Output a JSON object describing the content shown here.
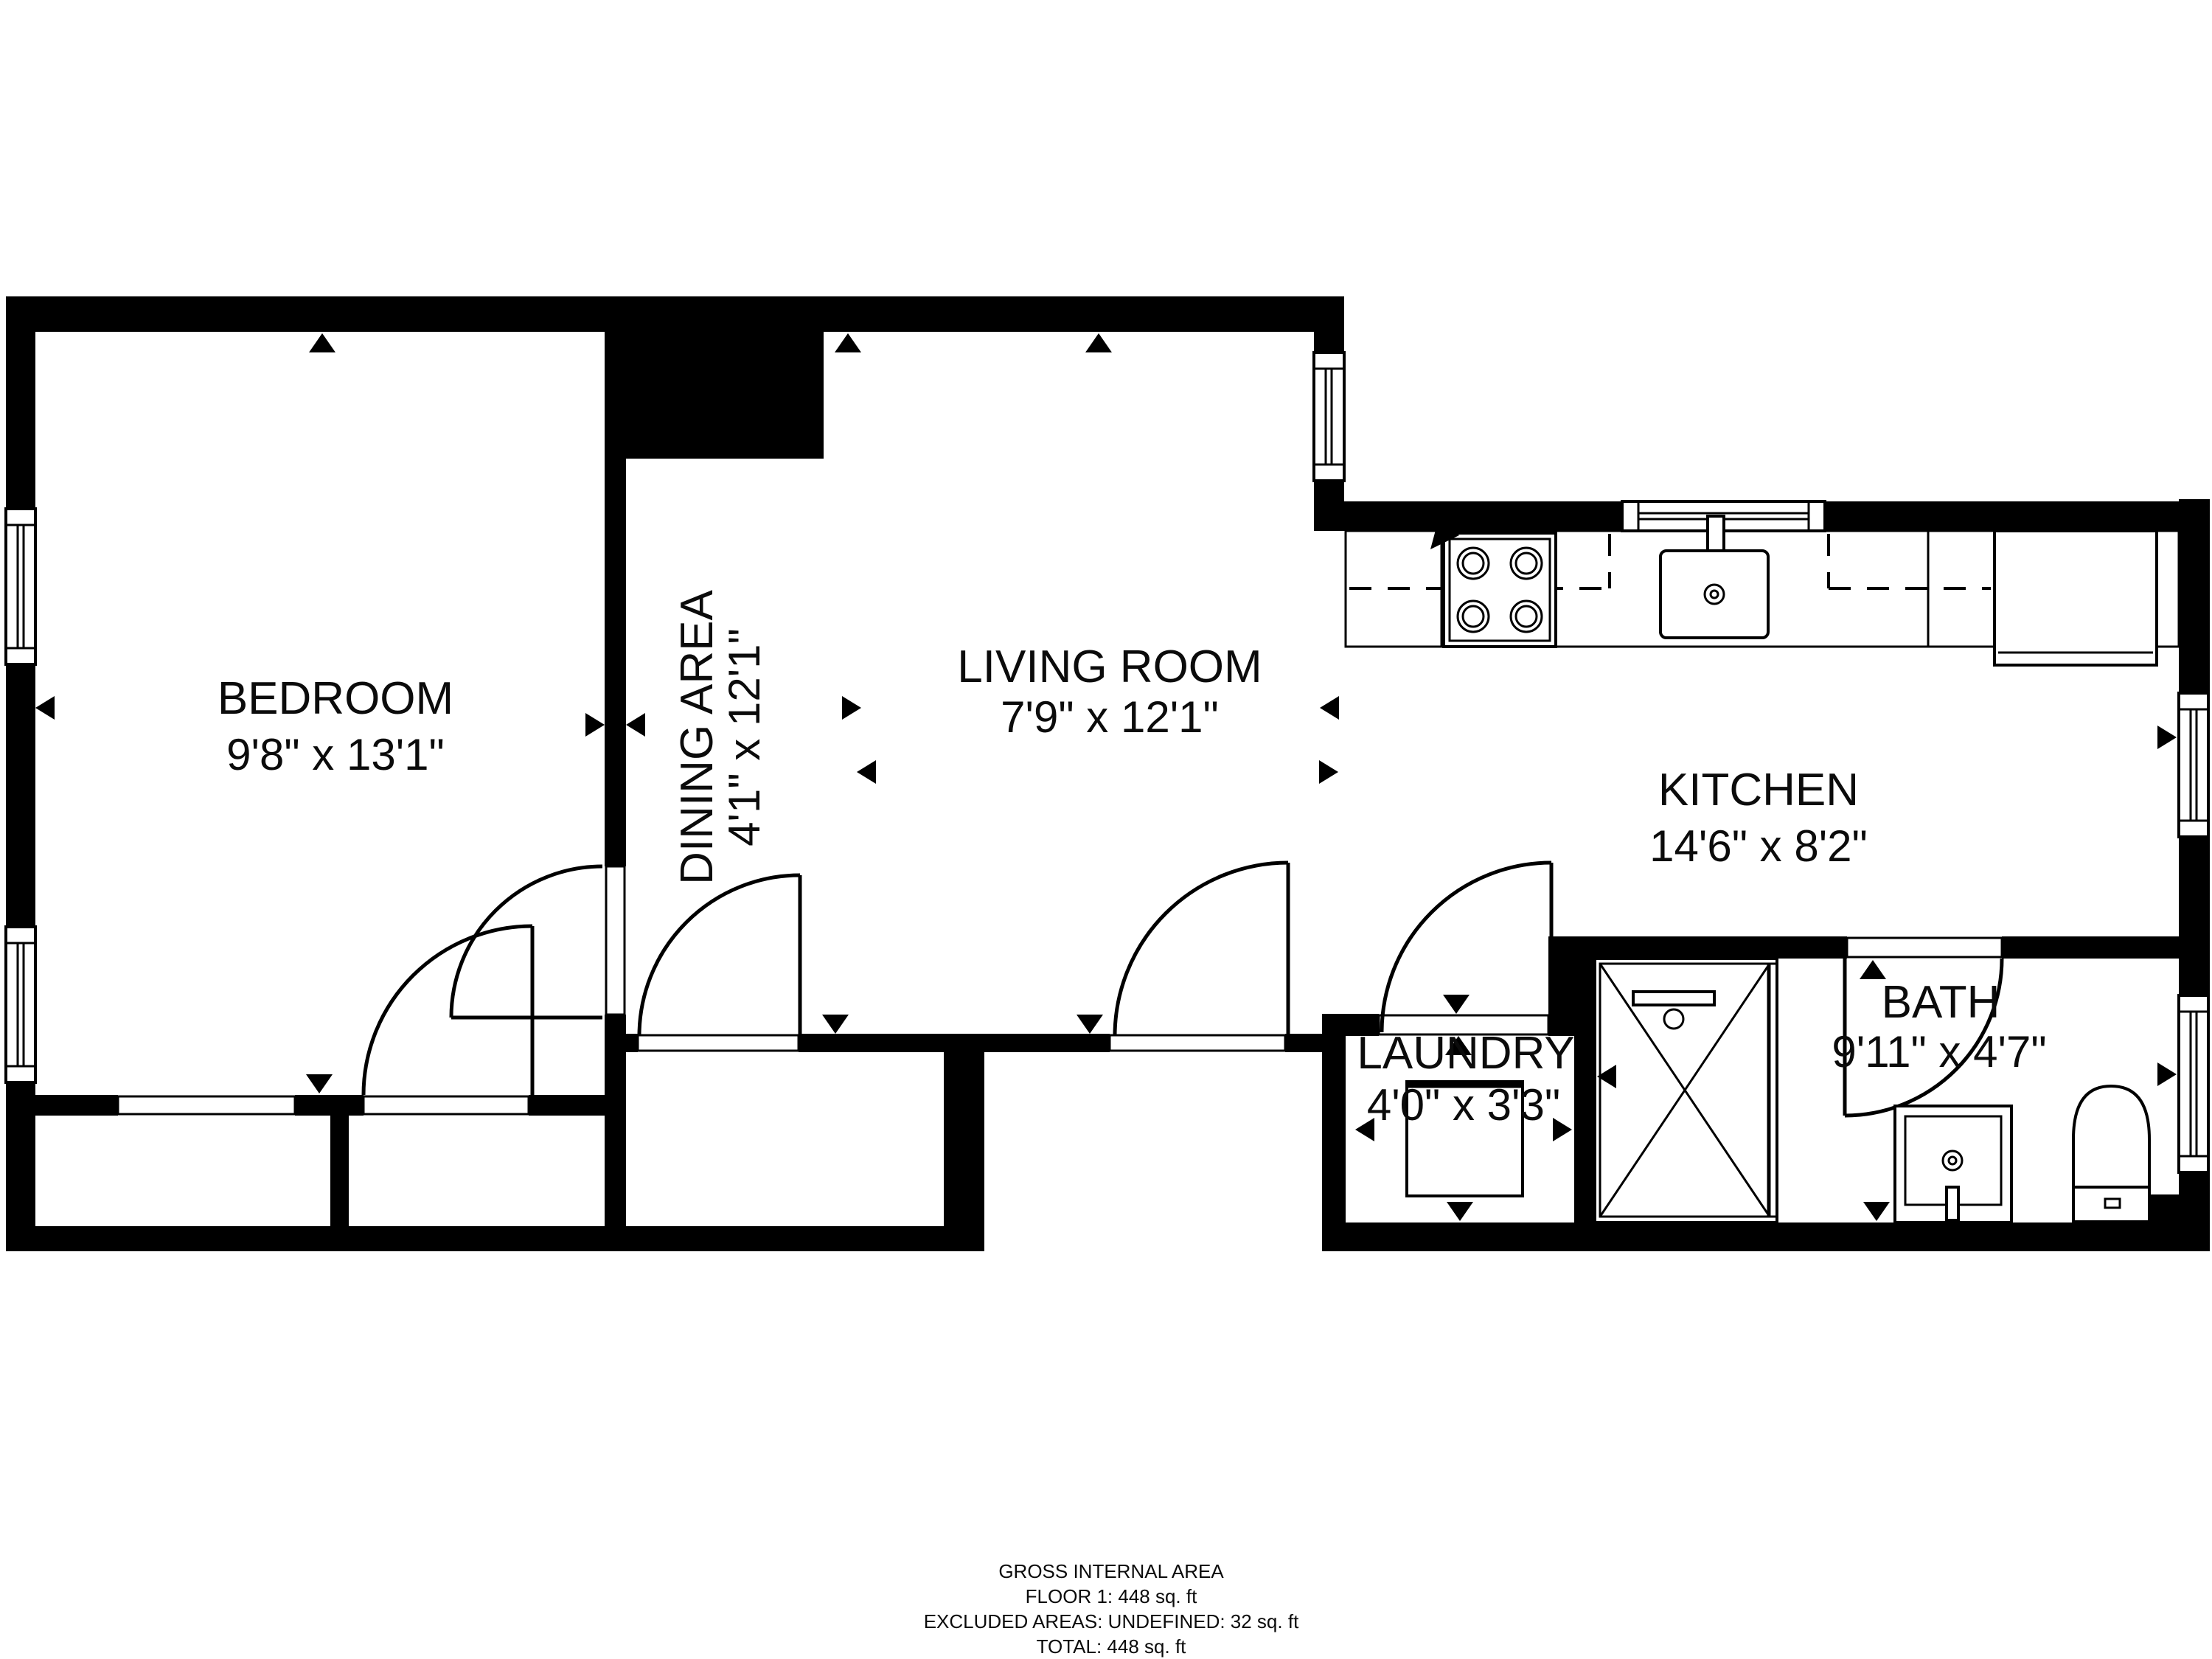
{
  "colors": {
    "wall": "#000000",
    "background": "#ffffff",
    "text": "#0b0b0b"
  },
  "rooms": {
    "bedroom": {
      "label": "BEDROOM",
      "dims": "9'8\" x 13'1\""
    },
    "dining": {
      "label": "DINING AREA",
      "dims": "4'1\" x 12'1\""
    },
    "living": {
      "label": "LIVING ROOM",
      "dims": "7'9\" x 12'1\""
    },
    "kitchen": {
      "label": "KITCHEN",
      "dims": "14'6\" x 8'2\""
    },
    "laundry": {
      "label": "LAUNDRY",
      "dims": "4'0\" x 3'3\""
    },
    "bath": {
      "label": "BATH",
      "dims": "9'11\" x 4'7\""
    }
  },
  "footer": {
    "line1": "GROSS INTERNAL AREA",
    "line2": "FLOOR 1: 448 sq. ft",
    "line3": "EXCLUDED AREAS: UNDEFINED: 32 sq. ft",
    "line4": "TOTAL: 448 sq. ft"
  }
}
